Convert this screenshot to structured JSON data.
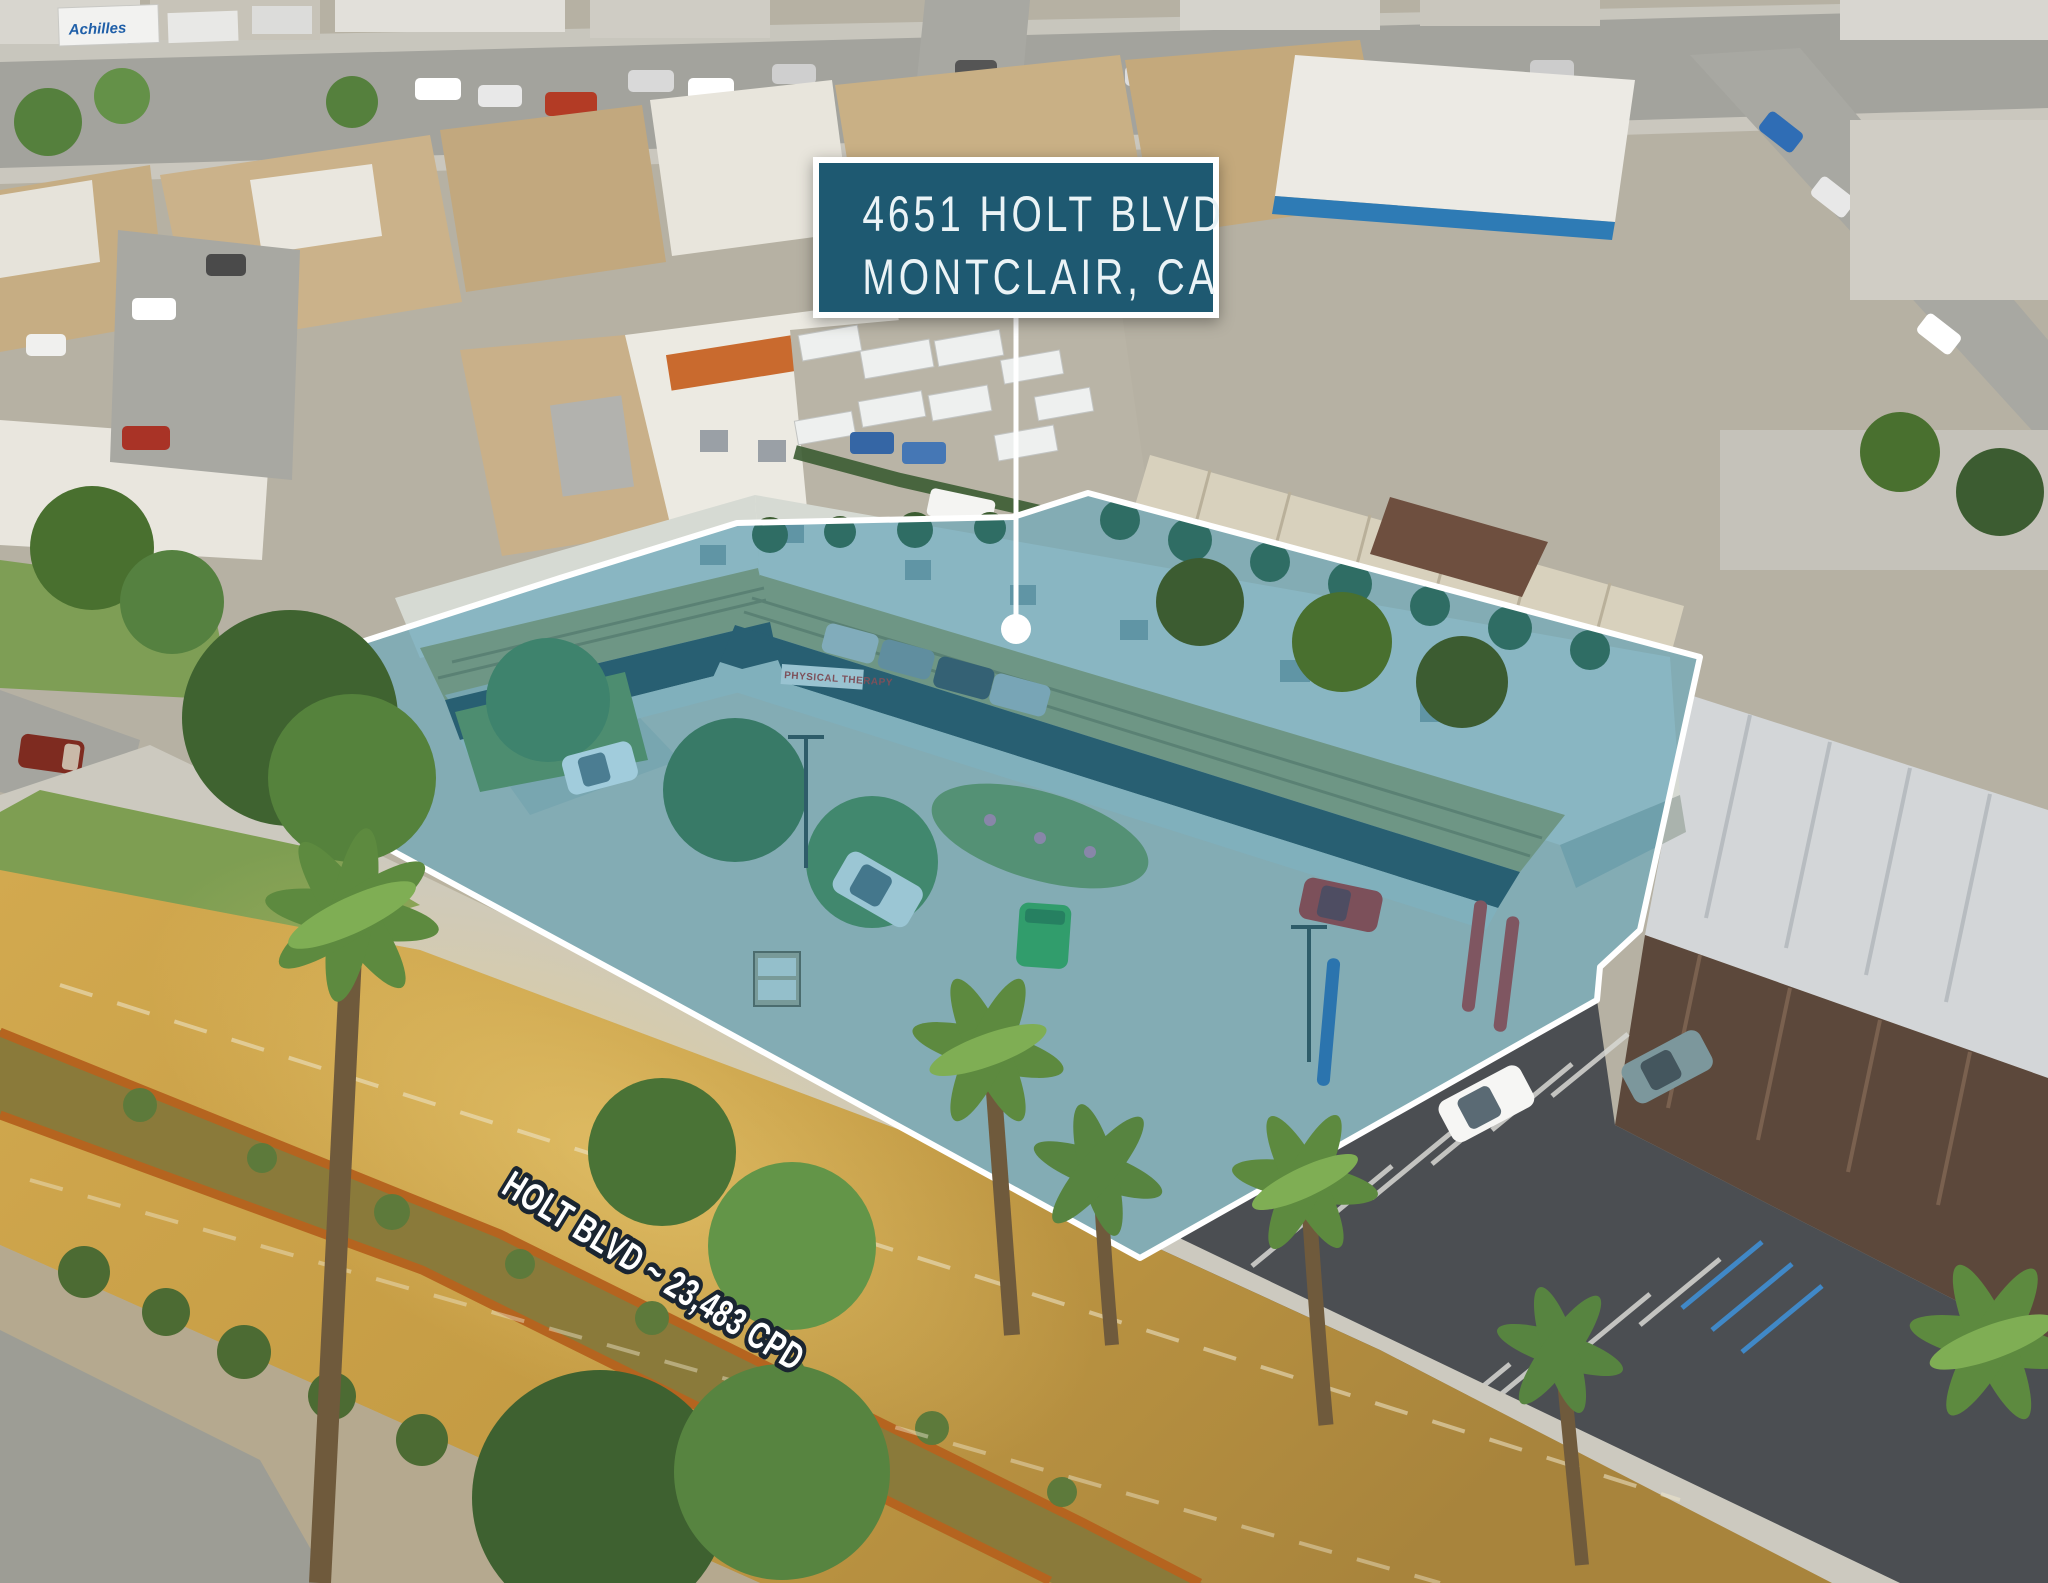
{
  "callout": {
    "address_line1": "4651 HOLT BLVD",
    "address_line2": "MONTCLAIR, CA"
  },
  "street_label": {
    "text": "HOLT BLVD ~ 23,483 CPD"
  },
  "storefront_signs": {
    "physical_therapy": "PHYSICAL THERAPY",
    "massage": "MASSAGE"
  },
  "vehicle_branding": {
    "truck_trailer": "Achilles"
  },
  "colors": {
    "callout_background": "#1e5971",
    "callout_border": "#ffffff",
    "callout_text": "#eaf3f6",
    "overlay_fill": "#1f86ab",
    "overlay_outline": "#ffffff",
    "street_label_fill": "#ffffff",
    "street_label_outline": "#1a2531",
    "road_surface_gold": "#c59c44",
    "median_soil": "#b5641f",
    "neighbor_asphalt": "#4b4e52"
  }
}
